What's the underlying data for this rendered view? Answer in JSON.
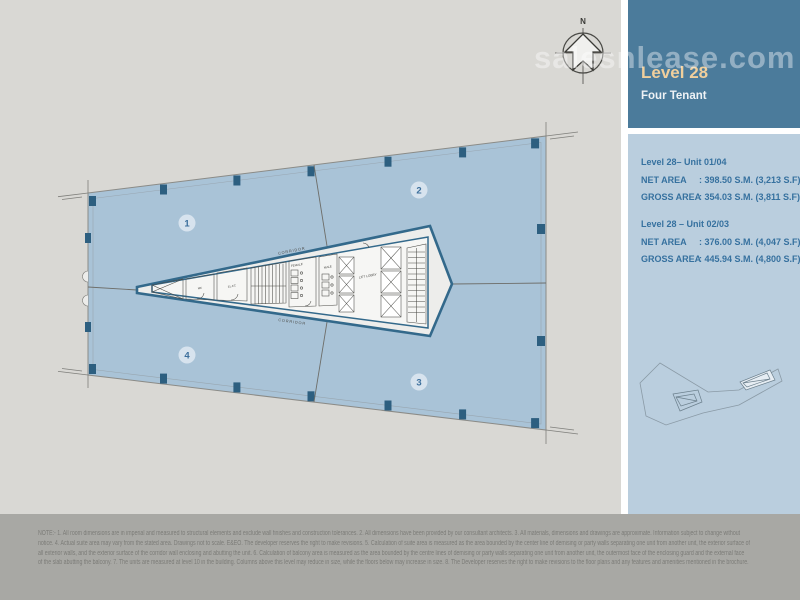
{
  "watermark": "salesnlease.com",
  "sidebar": {
    "level_title": "Level 28",
    "subtitle": "Four Tenant",
    "units": [
      {
        "title": "Level 28– Unit 01/04",
        "rows": [
          {
            "label": "NET AREA",
            "value": ": 398.50 S.M. (3,213 S.F)"
          },
          {
            "label": "GROSS AREA",
            "value": ": 354.03 S.M. (3,811 S.F)"
          }
        ]
      },
      {
        "title": "Level 28 – Unit 02/03",
        "rows": [
          {
            "label": "NET AREA",
            "value": ": 376.00 S.M. (4,047 S.F)"
          },
          {
            "label": "GROSS AREA",
            "value": ": 445.94 S.M. (4,800 S.F)"
          }
        ]
      }
    ]
  },
  "plan": {
    "compass_label": "N",
    "unit_badges": [
      "1",
      "2",
      "3",
      "4"
    ],
    "labels": {
      "corridor_top": "CORRIDOR",
      "corridor_bottom": "CORRIDOR",
      "female": "FEMALE",
      "male": "MALE",
      "lift_lobby": "LIFT LOBBY",
      "room_me": "ME",
      "room_elec": "EL.EC"
    }
  },
  "footer": {
    "lines": [
      "NOTE:- 1. All room dimensions are in imperial and measured to structural elements and exclude wall finishes and construction tolerances. 2. All dimensions have been provided by our consultant architects. 3. All materials, dimensions and drawings are approximate. Information subject to change without",
      "notice. 4. Actual suite area may vary from the stated area. Drawings not to scale. E&EO. The developer reserves the right to make revisions. 5. Calculation of suite area is measured as the area bounded by the center line of demising or party walls separating one unit from another unit, the exterior surface of",
      "all exterior walls, and the exterior surface of the corridor wall enclosing and abutting the unit. 6. Calculation of balcony area is measured as the area bounded by the centre lines of demising or party walls separating one unit from another unit, the outermost face of the enclosing guard and the external face",
      "of the slab abutting the balcony. 7. The units are measured at level 10 in the building. Columns above this level may reduce in size, while the floors below may increase in size. 8. The Developer reserves the right to make revisions to the floor plans and any features and amenities mentioned in the brochure."
    ]
  },
  "colors": {
    "page_bg": "#d9d8d4",
    "footer_bg": "#a8a8a4",
    "sidebar_header_bg": "#4b7b9b",
    "sidebar_panel_bg": "#bacede",
    "sidebar_text": "#36719f",
    "level_title_accent": "#f0cf9c",
    "unit_fill": "#a9c3d7",
    "core_wall": "#33698b",
    "column_fill": "#2d5f80"
  }
}
